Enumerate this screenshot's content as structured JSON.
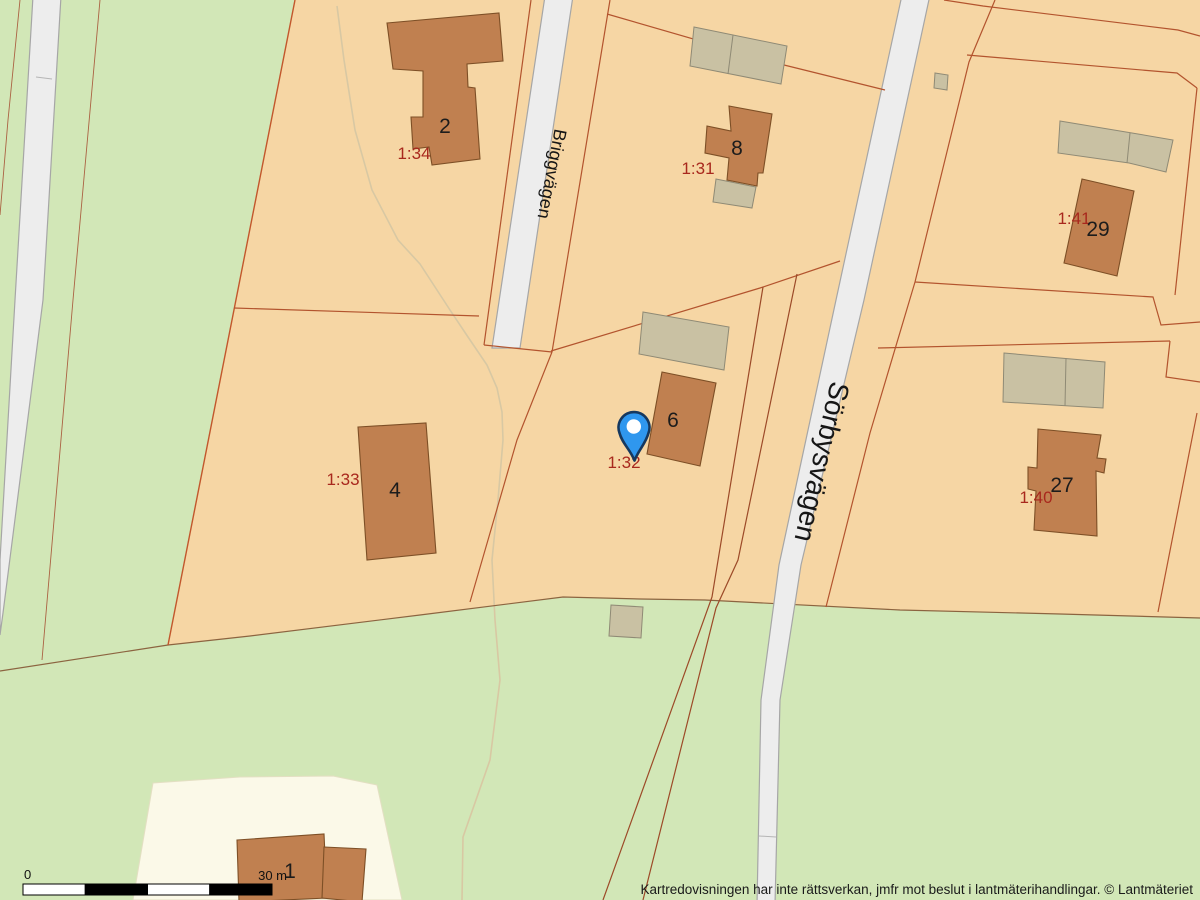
{
  "map_labels": {
    "streets": [
      "Briggvägen",
      "Sörbysvägen"
    ],
    "parcels": [
      "1:34",
      "1:31",
      "1:41",
      "1:33",
      "1:32",
      "1:40"
    ],
    "houses": [
      "2",
      "8",
      "29",
      "4",
      "6",
      "27",
      "1"
    ]
  },
  "marker": {
    "kind": "location-pin",
    "color": "#2f97ee"
  },
  "scale_bar": {
    "zero": "0",
    "max": "30 m"
  },
  "footer": {
    "disclaimer": "Kartredovisningen har inte rättsverkan, jmfr mot beslut i lantmäterihandlingar. © Lantmäteriet"
  },
  "colors": {
    "grass": "#d2e7b7",
    "parcel_fill": "#f6d6a4",
    "cream_parcel": "#fbf9e8",
    "building": "#c08050",
    "outbuilding": "#c9c1a3",
    "boundary_red": "#b3542e",
    "road_fill": "#ededed",
    "road_casing": "#a6a6a6",
    "parcel_label": "#a8281d"
  }
}
